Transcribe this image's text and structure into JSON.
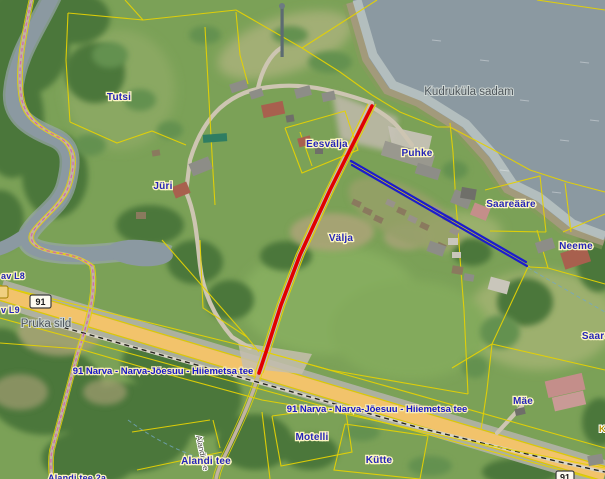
{
  "map": {
    "labels": {
      "places": [
        {
          "id": "tutsi",
          "text": "Tutsi"
        },
        {
          "id": "juri",
          "text": "Jüri"
        },
        {
          "id": "eesvalja",
          "text": "Eesvälja"
        },
        {
          "id": "puhke",
          "text": "Puhke"
        },
        {
          "id": "valja",
          "text": "Välja"
        },
        {
          "id": "saareaare",
          "text": "Saareääre"
        },
        {
          "id": "neeme",
          "text": "Neeme"
        },
        {
          "id": "saare",
          "text": "Saare"
        },
        {
          "id": "mae",
          "text": "Mäe"
        },
        {
          "id": "motelli",
          "text": "Motelli"
        },
        {
          "id": "kutte",
          "text": "Kütte"
        },
        {
          "id": "alandi-tee",
          "text": "Alandi tee"
        },
        {
          "id": "alandi-tee-2a",
          "text": "Alandi tee 2a"
        },
        {
          "id": "av-l8",
          "text": "av L8"
        },
        {
          "id": "v-l9",
          "text": "v L9"
        },
        {
          "id": "k-partial",
          "text": "K"
        }
      ],
      "gray": [
        {
          "id": "kudrukula-sadam",
          "text": "Kudruküla sadam"
        },
        {
          "id": "pruka-sild",
          "text": "Pruka sild"
        }
      ],
      "roads": [
        {
          "id": "road-91-west",
          "text": "91 Narva - Narva-Jõesuu - Hiiemetsa tee"
        },
        {
          "id": "road-91-east",
          "text": "91 Narva - Narva-Jõesuu - Hiiemetsa tee"
        },
        {
          "id": "street-alandi",
          "text": "Alandi tee"
        }
      ],
      "shields": [
        {
          "id": "shield-91",
          "text": "91"
        },
        {
          "id": "shield-91-br",
          "text": "91"
        }
      ]
    },
    "colors": {
      "water": "#8b99a1",
      "grass": "#7ba157",
      "cadastral_yellow": "#e4d104",
      "highway_orange": "#f2c36b",
      "route_red": "#e10000",
      "route_blue": "#1c1ccd",
      "label_blue": "#2525b8",
      "label_halo": "#fdf6c2",
      "label_gray": "#4e565b"
    }
  }
}
